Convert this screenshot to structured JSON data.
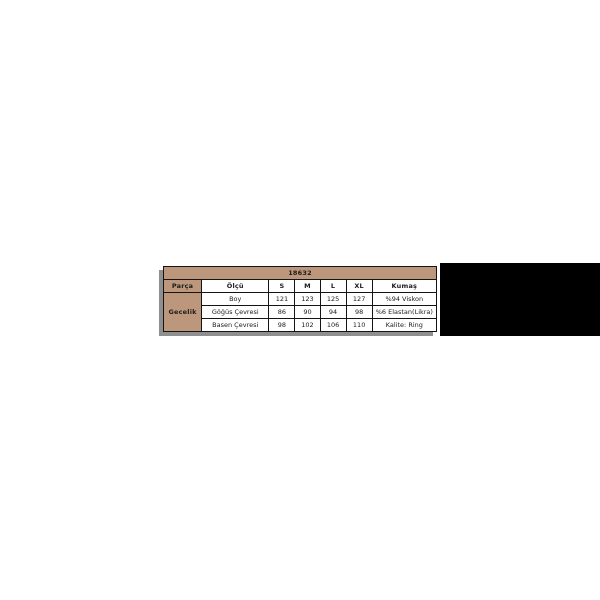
{
  "size_chart": {
    "product_code": "18632",
    "headers": [
      "Parça",
      "Ölçü",
      "S",
      "M",
      "L",
      "XL",
      "Kumaş"
    ],
    "row_group": "Gecelik",
    "rows": [
      {
        "label": "Boy",
        "s": "121",
        "m": "123",
        "l": "125",
        "xl": "127",
        "kumas": "%94 Viskon"
      },
      {
        "label": "Göğüs Çevresi",
        "s": "86",
        "m": "90",
        "l": "94",
        "xl": "98",
        "kumas": "%6 Elastan(Likra)"
      },
      {
        "label": "Basen Çevresi",
        "s": "98",
        "m": "102",
        "l": "106",
        "xl": "110",
        "kumas": "Kalite: Ring"
      }
    ],
    "colors": {
      "header_bg": "#bc977b",
      "border": "#141414",
      "shadow": "#8f8f8f",
      "black_panel": "#000000",
      "background": "#ffffff"
    }
  },
  "chart_data": {
    "type": "table",
    "title": "18632",
    "columns": [
      "Parça",
      "Ölçü",
      "S",
      "M",
      "L",
      "XL",
      "Kumaş"
    ],
    "rows": [
      [
        "Gecelik",
        "Boy",
        121,
        123,
        125,
        127,
        "%94 Viskon"
      ],
      [
        "Gecelik",
        "Göğüs Çevresi",
        86,
        90,
        94,
        98,
        "%6 Elastan(Likra)"
      ],
      [
        "Gecelik",
        "Basen Çevresi",
        98,
        102,
        106,
        110,
        "Kalite: Ring"
      ]
    ]
  }
}
